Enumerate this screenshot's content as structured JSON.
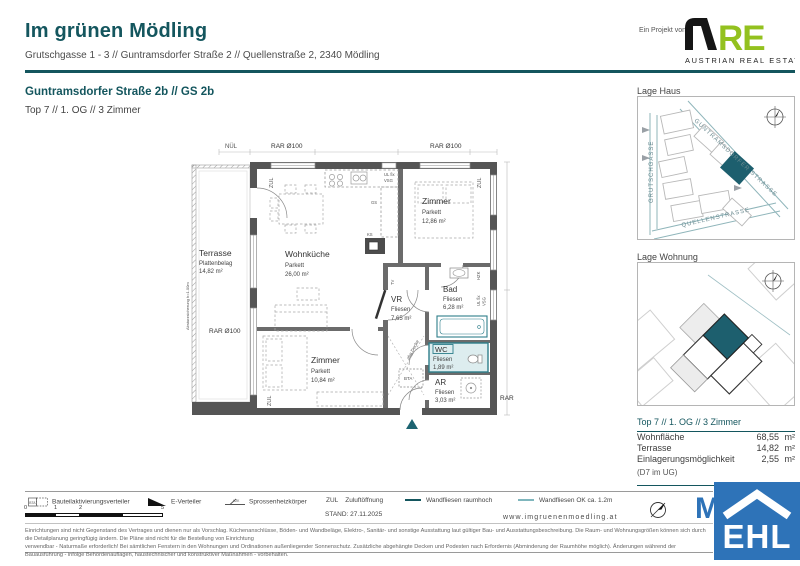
{
  "header": {
    "project_label": "Ein Projekt von",
    "title": "Im grünen Mödling",
    "address": "Grutschgasse 1 - 3 // Guntramsdorfer Straße 2 // Quellenstraße 2, 2340 Mödling",
    "unit_title": "Guntramsdorfer Straße 2b // GS 2b",
    "unit_subtitle": "Top 7 // 1. OG // 3 Zimmer",
    "are_logo": {
      "re": "RE",
      "caption": "AUSTRIAN REAL ESTATE"
    }
  },
  "plan": {
    "rooms": [
      {
        "name": "Terrasse",
        "floor": "Plattenbelag",
        "area": "14,82 m²"
      },
      {
        "name": "Wohnküche",
        "floor": "Parkett",
        "area": "26,00 m²"
      },
      {
        "name": "Zimmer",
        "floor": "Parkett",
        "area": "12,86 m²"
      },
      {
        "name": "Zimmer",
        "floor": "Parkett",
        "area": "10,84 m²"
      },
      {
        "name": "VR",
        "floor": "Fliesen",
        "area": "7,65 m²"
      },
      {
        "name": "Bad",
        "floor": "Fliesen",
        "area": "6,28 m²"
      },
      {
        "name": "WC",
        "floor": "Fliesen",
        "area": "1,89 m²"
      },
      {
        "name": "AR",
        "floor": "Fliesen",
        "area": "3,03 m²"
      }
    ],
    "annotations": {
      "nuel": "NÜL",
      "rar100": "RAR Ø100",
      "rar": "RAR",
      "zul": "ZUL",
      "ul_fix": "UL fix",
      "vsg": "VSG",
      "hzk": "HZK",
      "ks": "KS",
      "gs": "GS",
      "tv": "TV",
      "bta": "BTA",
      "abg_decke": "abg.Decke",
      "absturz": "Absturzsicherung h=1.00m"
    }
  },
  "sidebar": {
    "lage_haus": {
      "title": "Lage Haus",
      "streets": {
        "guntramsdorfer": "GUNTRAMSDORFER STRASSE",
        "grutschgasse": "GRUTSCHGASSE",
        "quellenstrasse": "QUELLENSTRASSE"
      }
    },
    "lage_wohnung": {
      "title": "Lage Wohnung"
    },
    "info": {
      "title": "Top 7 // 1. OG // 3 Zimmer",
      "rows": [
        {
          "label": "Wohnfläche",
          "value": "68,55",
          "unit": "m²"
        },
        {
          "label": "Terrasse",
          "value": "14,82",
          "unit": "m²"
        },
        {
          "label": "Einlagerungsmöglichkeit",
          "value": "2,55",
          "unit": "m²"
        }
      ],
      "note": "(D7 im UG)"
    }
  },
  "footer": {
    "legend": [
      {
        "label": "Bauteilaktivierungsverteiler"
      },
      {
        "label": "E-Verteiler"
      },
      {
        "label": "Sprossenheizkörper"
      },
      {
        "prefix": "ZUL",
        "label": "Zuluftöffnung"
      },
      {
        "label": "Wandfliesen raumhoch"
      },
      {
        "label": "Wandfliesen OK ca. 1.2m"
      }
    ],
    "scale_ticks": [
      "0",
      "1",
      "2",
      "5"
    ],
    "stand": "STAND: 27.11.2025",
    "website": "www.imgruenenmoedling.at",
    "disclaimer_line1": "Einrichtungen sind nicht Gegenstand des Vertrages und dienen nur als Vorschlag. Küchenanschlüsse, Böden- und Wandbeläge, Elektro-, Sanitär- und sonstige Ausstattung laut gültiger Bau- und Ausstattungsbeschreibung. Die Raum- und Wohnungsgrößen können sich durch die Detailplanung geringfügig ändern. Die Pläne sind nicht für die Bestellung von Einrichtung",
    "disclaimer_line2": "verwendbar - Naturmaße erforderlich! Bei sämtlichen Fenstern in den Wohnungen und Ordinationen außenliegender Sonnenschutz. Zusätzliche abgehängte Decken und Podesten nach Erfordernis (Abminderung der Raumhöhe möglich). Änderungen während der Bauausführung - infolge Behördenauflagen, haustechnischer und konstruktiver Maßnahmen - vorbehalten.",
    "ehl": "EHL",
    "watermark_m": "M"
  },
  "colors": {
    "teal": "#14565e",
    "plan_accent": "#2d7e8a",
    "highlight": "#1d5f6e",
    "ehl_blue": "#2e73b8",
    "are_green": "#93c11f"
  }
}
